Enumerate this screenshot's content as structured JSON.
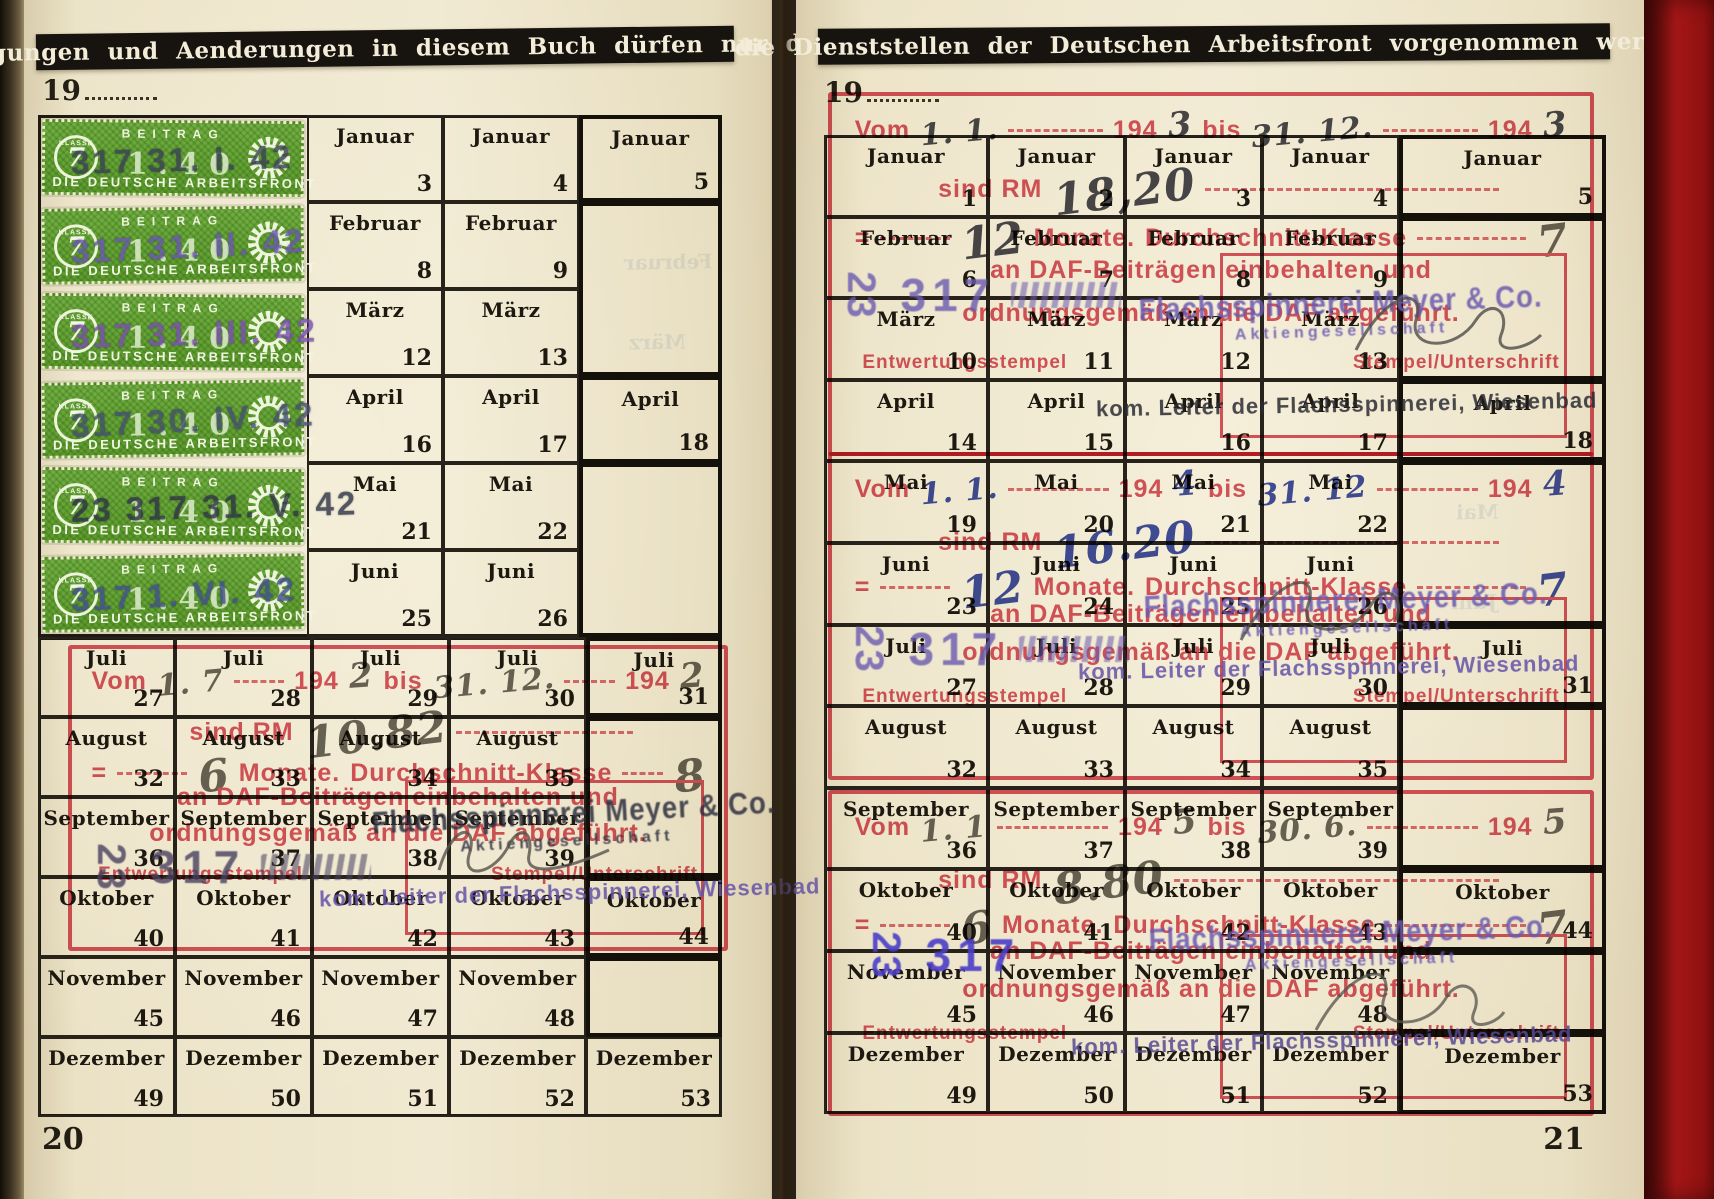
{
  "banners": {
    "left": "Eintragungen und Aenderungen in diesem Buch dürfen nur durch",
    "right": "die Dienststellen der Deutschen Arbeitsfront vorgenommen werden"
  },
  "pages": {
    "left": {
      "year_prefix": "19",
      "page_number": "20"
    },
    "right": {
      "year_prefix": "19",
      "page_number": "21"
    }
  },
  "grid": {
    "left_rows": [
      {
        "month": "Januar",
        "cells": [
          {
            "n": "3"
          },
          {
            "n": "4"
          },
          {
            "n": "5",
            "b": true
          }
        ]
      },
      {
        "month": "Februar",
        "cells": [
          {
            "n": "8"
          },
          {
            "n": "9"
          }
        ]
      },
      {
        "month": "März",
        "cells": [
          {
            "n": "12"
          },
          {
            "n": "13"
          }
        ]
      },
      {
        "month": "April",
        "cells": [
          {
            "n": "16"
          },
          {
            "n": "17"
          },
          {
            "n": "18",
            "b": true
          }
        ]
      },
      {
        "month": "Mai",
        "cells": [
          {
            "n": "21"
          },
          {
            "n": "22"
          }
        ]
      },
      {
        "month": "Juni",
        "cells": [
          {
            "n": "25"
          },
          {
            "n": "26"
          }
        ]
      },
      {
        "month": "Juli",
        "cells": [
          {
            "n": "27"
          },
          {
            "n": "28"
          },
          {
            "n": "29"
          },
          {
            "n": "30"
          },
          {
            "n": "31",
            "b": true
          }
        ]
      },
      {
        "month": "August",
        "cells": [
          {
            "n": "32"
          },
          {
            "n": "33"
          },
          {
            "n": "34"
          },
          {
            "n": "35"
          }
        ]
      },
      {
        "month": "September",
        "cells": [
          {
            "n": "36"
          },
          {
            "n": "37"
          },
          {
            "n": "38"
          },
          {
            "n": "39"
          }
        ]
      },
      {
        "month": "Oktober",
        "cells": [
          {
            "n": "40"
          },
          {
            "n": "41"
          },
          {
            "n": "42"
          },
          {
            "n": "43"
          },
          {
            "n": "44",
            "b": true
          }
        ]
      },
      {
        "month": "November",
        "cells": [
          {
            "n": "45"
          },
          {
            "n": "46"
          },
          {
            "n": "47"
          },
          {
            "n": "48"
          }
        ]
      },
      {
        "month": "Dezember",
        "cells": [
          {
            "n": "49"
          },
          {
            "n": "50"
          },
          {
            "n": "51"
          },
          {
            "n": "52"
          },
          {
            "n": "53"
          }
        ]
      }
    ],
    "right_rows": [
      {
        "month": "Januar",
        "cells": [
          {
            "n": "1"
          },
          {
            "n": "2"
          },
          {
            "n": "3"
          },
          {
            "n": "4"
          },
          {
            "n": "5",
            "b": true
          }
        ]
      },
      {
        "month": "Februar",
        "cells": [
          {
            "n": "6"
          },
          {
            "n": "7"
          },
          {
            "n": "8"
          },
          {
            "n": "9"
          }
        ]
      },
      {
        "month": "März",
        "cells": [
          {
            "n": "10"
          },
          {
            "n": "11"
          },
          {
            "n": "12"
          },
          {
            "n": "13"
          }
        ]
      },
      {
        "month": "April",
        "cells": [
          {
            "n": "14"
          },
          {
            "n": "15"
          },
          {
            "n": "16"
          },
          {
            "n": "17"
          },
          {
            "n": "18",
            "b": true
          }
        ]
      },
      {
        "month": "Mai",
        "cells": [
          {
            "n": "19"
          },
          {
            "n": "20"
          },
          {
            "n": "21"
          },
          {
            "n": "22"
          }
        ]
      },
      {
        "month": "Juni",
        "cells": [
          {
            "n": "23"
          },
          {
            "n": "24"
          },
          {
            "n": "25"
          },
          {
            "n": "26"
          }
        ]
      },
      {
        "month": "Juli",
        "cells": [
          {
            "n": "27"
          },
          {
            "n": "28"
          },
          {
            "n": "29"
          },
          {
            "n": "30"
          },
          {
            "n": "31",
            "b": true
          }
        ]
      },
      {
        "month": "August",
        "cells": [
          {
            "n": "32"
          },
          {
            "n": "33"
          },
          {
            "n": "34"
          },
          {
            "n": "35"
          }
        ]
      },
      {
        "month": "September",
        "cells": [
          {
            "n": "36"
          },
          {
            "n": "37"
          },
          {
            "n": "38"
          },
          {
            "n": "39"
          }
        ]
      },
      {
        "month": "Oktober",
        "cells": [
          {
            "n": "40"
          },
          {
            "n": "41"
          },
          {
            "n": "42"
          },
          {
            "n": "43"
          },
          {
            "n": "44",
            "b": true
          }
        ]
      },
      {
        "month": "November",
        "cells": [
          {
            "n": "45"
          },
          {
            "n": "46"
          },
          {
            "n": "47"
          },
          {
            "n": "48"
          }
        ]
      },
      {
        "month": "Dezember",
        "cells": [
          {
            "n": "49"
          },
          {
            "n": "50"
          },
          {
            "n": "51"
          },
          {
            "n": "52"
          },
          {
            "n": "53",
            "b": true
          }
        ]
      }
    ]
  },
  "dues_stamps": {
    "beitrag_label": "BEITRAG",
    "klasse_label": "KLASSE",
    "klasse_value": "7",
    "center_value": "1.40",
    "org_label": "DIE DEUTSCHE ARBEITSFRONT",
    "green_hex": "#69a63a",
    "cancellations": [
      {
        "text": "317 31. I. 42",
        "color": "#3a4254"
      },
      {
        "text": "317 31. II. 42",
        "color": "#6a57b0"
      },
      {
        "text": "317 31. III. 42",
        "color": "#7b4fb0"
      },
      {
        "text": "317 30. IV. 42",
        "color": "#44506e"
      },
      {
        "text": "23 317 31. V. 42",
        "color": "#2f3545"
      },
      {
        "text": "317 1. VI. 42",
        "color": "#41508e"
      }
    ]
  },
  "red_template": {
    "vom": "Vom",
    "year": "194",
    "bis": "bis",
    "sind_rm": "sind RM",
    "equals": "=",
    "monate": "Monate.",
    "klasse": "Durchschnitt-Klasse",
    "withheld": "an DAF-Beiträgen einbehalten und",
    "remitted": "ordnungsgemäß an die DAF abgeführt.",
    "entwertung": "Entwertungsstempel",
    "stempel": "Stempel/Unterschrift",
    "red_hex": "#d5404f"
  },
  "blocks": [
    {
      "period": "1942 2nd half",
      "from": "1. 7",
      "year_from": "2",
      "to": "31. 12.",
      "year_to": "2",
      "rm": "10.82",
      "monate": "6",
      "klasse": "8"
    },
    {
      "period": "1943",
      "from": "1. 1.",
      "year_from": "3",
      "to": "31. 12.",
      "year_to": "3",
      "rm": "18,20",
      "monate": "12",
      "klasse": "7"
    },
    {
      "period": "1944",
      "from": "1. 1.",
      "year_from": "4",
      "to": "31. 12",
      "year_to": "4",
      "rm": "16.20",
      "monate": "12",
      "klasse": "7"
    },
    {
      "period": "1945 1st half",
      "from": "1. 1",
      "year_from": "5",
      "to": "30. 6.",
      "year_to": "5",
      "rm": "8.80",
      "monate": "6",
      "klasse": "7"
    }
  ],
  "company_stamp": {
    "name": "Flachsspinnerei Meyer & Co.",
    "sub": "Aktiengesellschaft",
    "leiter": "kom. Leiter der Flachsspinnerei, Wiesenbad"
  },
  "number_stamp": {
    "a": "23",
    "b": "317"
  },
  "ghosts": [
    "Februar",
    "März",
    "Mai",
    "Juni"
  ]
}
